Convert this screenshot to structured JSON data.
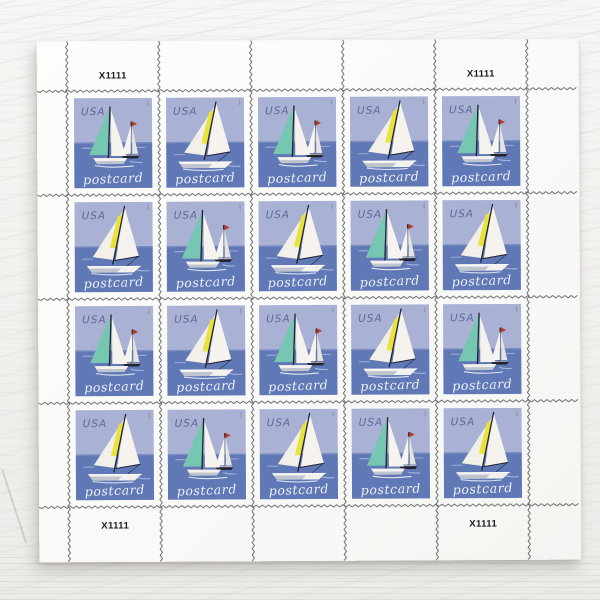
{
  "sheet": {
    "rows": 4,
    "cols": 5,
    "stamp_count": 20,
    "plate_numbers": {
      "top_left": "X1111",
      "top_right": "X1111",
      "bottom_left": "X1111",
      "bottom_right": "X1111"
    },
    "pattern": [
      [
        "A",
        "B",
        "A",
        "B",
        "A"
      ],
      [
        "B",
        "A",
        "B",
        "A",
        "B"
      ],
      [
        "A",
        "B",
        "A",
        "B",
        "A"
      ],
      [
        "B",
        "A",
        "B",
        "A",
        "B"
      ]
    ]
  },
  "stamp": {
    "country": "USA",
    "inscription": "postcard",
    "designs": {
      "A": {
        "name": "two-sailboats-teal-mainsail-red-pennant"
      },
      "B": {
        "name": "single-sailboat-yellow-sail-stripe"
      }
    }
  },
  "colors": {
    "sky": "#a9b2d4",
    "sea": "#6078b6",
    "teal": "#76c7b1",
    "yellow": "#e9e23d",
    "red": "#b23a2e",
    "mast": "#20242e",
    "hull_gray": "#bfc4cf",
    "usa_text": "#5d6b9b",
    "postcard_text": "#edf1f9",
    "perf": "#5b5b5b",
    "sheet_paper": "#fbfbfa"
  }
}
